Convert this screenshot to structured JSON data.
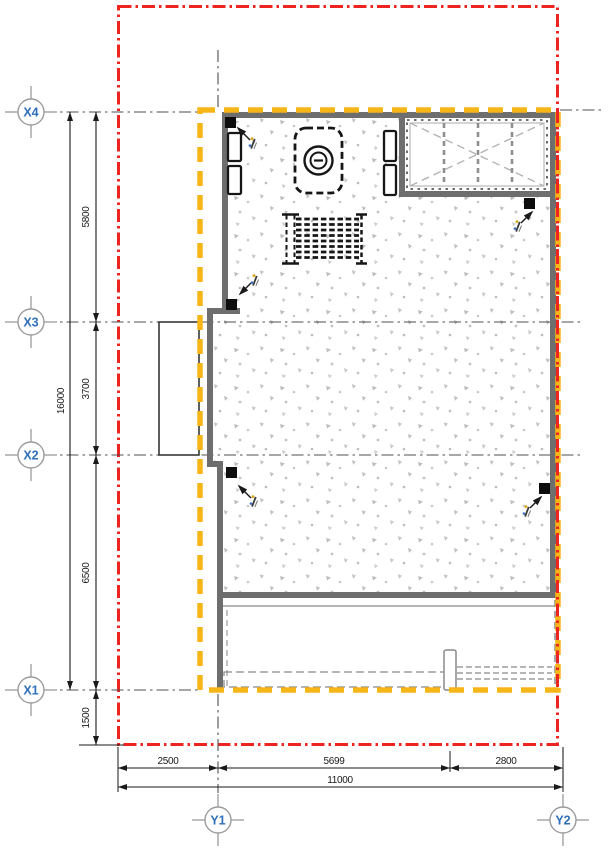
{
  "plan": {
    "grid_axes": {
      "x": [
        "X4",
        "X3",
        "X2",
        "X1"
      ],
      "y": [
        "Y1",
        "Y2"
      ]
    },
    "dimensions": {
      "left": {
        "overall": "16000",
        "segments": [
          "5800",
          "3700",
          "6500",
          "1500"
        ]
      },
      "bottom": {
        "overall": "11000",
        "segments": [
          "2500",
          "5699",
          "2800"
        ]
      }
    },
    "colors": {
      "boundary_red": "#ee2420",
      "boundary_yellow": "#f7b617",
      "wall_gray": "#6e6e6e",
      "grid_label_blue": "#2f6fba",
      "stipple_gray": "#bdbdbd"
    }
  }
}
